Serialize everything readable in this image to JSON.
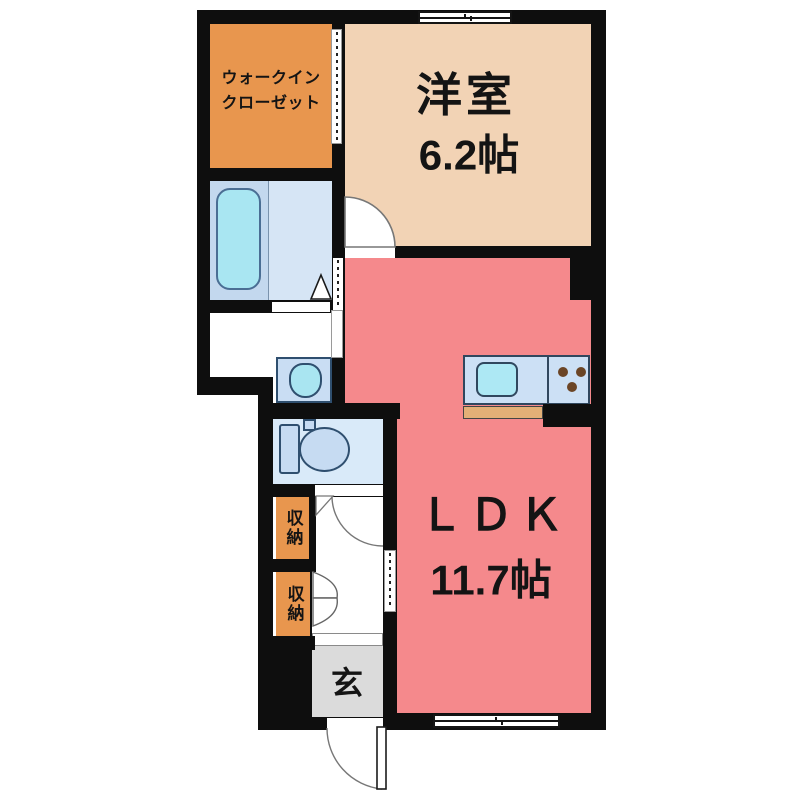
{
  "plan": {
    "type": "apartment-floor-plan",
    "rooms": {
      "walk_in_closet": {
        "line1": "ウォークイン",
        "line2": "クローゼット"
      },
      "western_room": {
        "name": "洋室",
        "size": "6.2帖"
      },
      "ldk": {
        "name": "ＬＤＫ",
        "size": "11.7帖"
      },
      "storage_upper": {
        "label": "収納"
      },
      "storage_lower": {
        "label": "収納"
      },
      "entrance": {
        "label": "玄"
      }
    },
    "colors": {
      "wall": "#0e0e0e",
      "closet_orange": "#E8964E",
      "western_room_tan": "#F2D3B5",
      "ldk_salmon": "#F5898C",
      "bathroom_blue_left": "#C3D8EE",
      "bathroom_blue_right": "#D6E5F5",
      "bathtub_cyan": "#A9E6F2",
      "toilet_room_blue": "#D9EAF9",
      "fixture_blue": "#C6DBF2",
      "kitchen_counter_blue": "#CCE0F5",
      "sink_cyan": "#ADE8F4",
      "counter_wood": "#E3B077",
      "burner_brown": "#6B4526",
      "genkan_gray": "#DBDBDB"
    }
  }
}
